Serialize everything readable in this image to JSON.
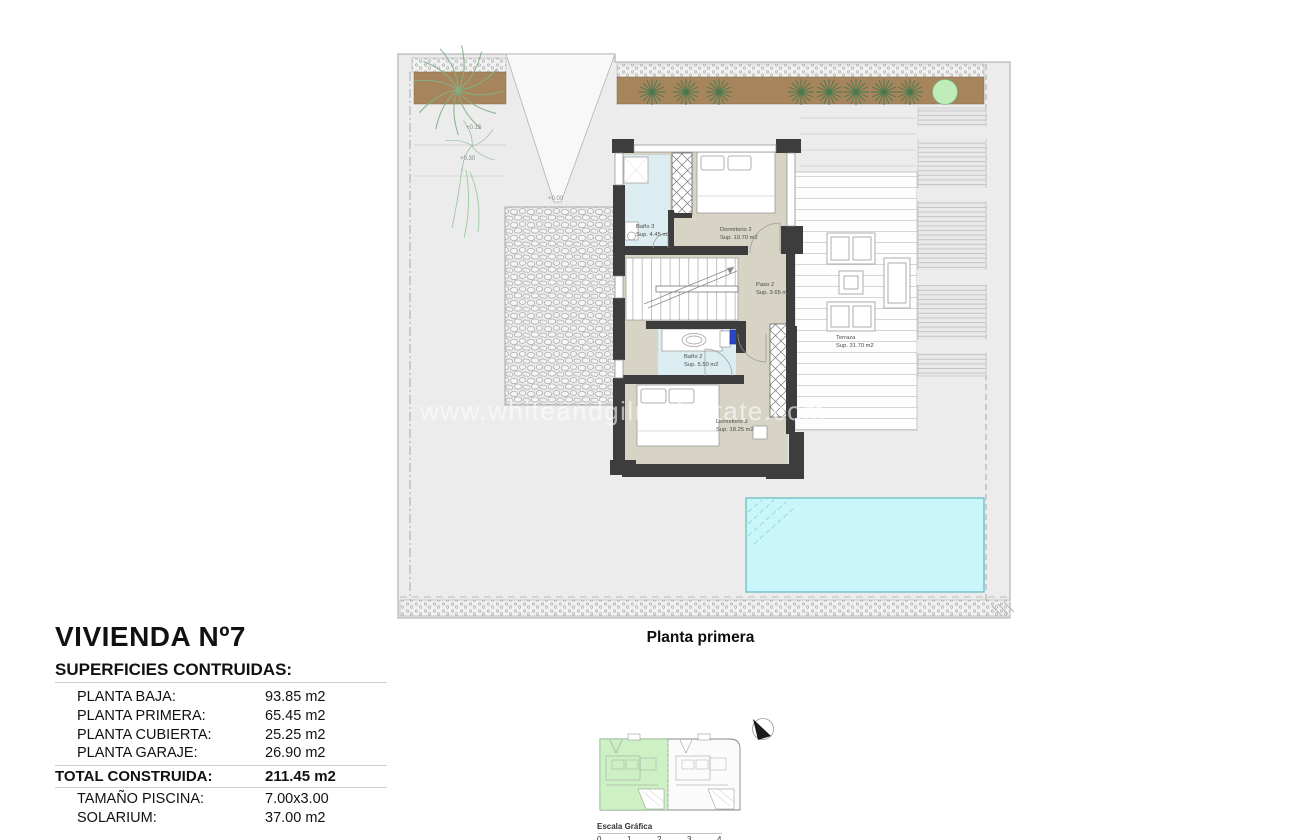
{
  "watermark": "www.whiteandgilrealestate.com",
  "plan": {
    "caption": "Planta primera",
    "rooms": {
      "bano3": {
        "name": "Baño 3",
        "area": "Sup. 4.45 m2"
      },
      "dorm2": {
        "name": "Dormitorio 2",
        "area": "Sup. 10.70 m2"
      },
      "paso2": {
        "name": "Paso 2",
        "area": "Sup. 3.65 m2"
      },
      "bano2": {
        "name": "Baño 2",
        "area": "Sup. 5.50 m2"
      },
      "dorm3": {
        "name": "Dormitorio 3",
        "area": "Sup. 18.25 m2"
      },
      "terraza": {
        "name": "Terraza",
        "area": "Sup. 31.70 m2"
      }
    },
    "levels": {
      "left_upper": "+0.15",
      "left_lower": "+0.30",
      "driveway": "+0.00",
      "right_upper": "+0.15",
      "right_lower": "+0.30"
    }
  },
  "title_block": {
    "title": "VIVIENDA Nº7",
    "subtitle": "SUPERFICIES CONTRUIDAS:",
    "rows": [
      {
        "label": "PLANTA BAJA:",
        "value": "93.85 m2"
      },
      {
        "label": "PLANTA PRIMERA:",
        "value": "65.45 m2"
      },
      {
        "label": "PLANTA CUBIERTA:",
        "value": "25.25 m2"
      },
      {
        "label": "PLANTA GARAJE:",
        "value": "26.90 m2"
      }
    ],
    "total": {
      "label": "TOTAL CONSTRUIDA:",
      "value": "211.45 m2"
    },
    "extras": [
      {
        "label": "TAMAÑO PISCINA:",
        "value": "7.00x3.00"
      },
      {
        "label": "SOLARIUM:",
        "value": "37.00 m2"
      }
    ]
  },
  "key_plan": {
    "scale_label": "Escala Gráfica",
    "scale_ticks": [
      "0",
      "1",
      "2",
      "3",
      "4"
    ]
  },
  "colors": {
    "floor_beige": "#d7d3c5",
    "bath_blue": "#dbedf0",
    "wall_dark": "#3d3d3d",
    "pool_cyan": "#c9f6fa",
    "garden_brown": "#a6845c",
    "keyplan_green": "#cdf0c4"
  }
}
